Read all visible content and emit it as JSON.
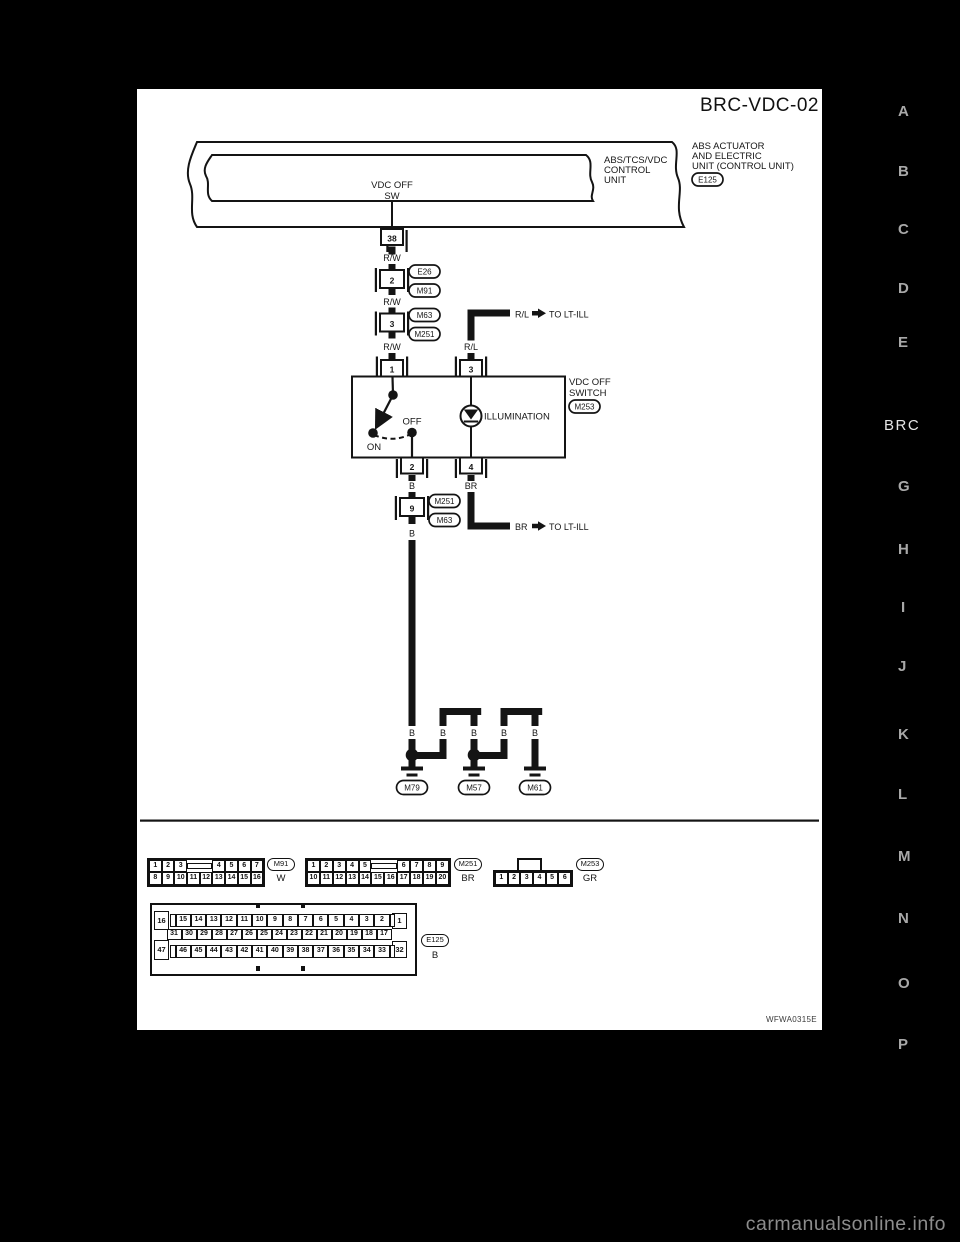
{
  "page": {
    "title": "BRC-VDC-02",
    "figure_code": "WFWA0315E",
    "watermark": "carmanualsonline.info"
  },
  "side_index": {
    "section": "BRC",
    "letters": [
      "A",
      "B",
      "C",
      "D",
      "E",
      "G",
      "H",
      "I",
      "J",
      "K",
      "L",
      "M",
      "N",
      "O",
      "P"
    ]
  },
  "unit": {
    "outer_name": [
      "ABS ACTUATOR",
      "AND ELECTRIC",
      "UNIT (CONTROL UNIT)"
    ],
    "outer_connector": "E125",
    "inner_name": [
      "ABS/TCS/VDC",
      "CONTROL",
      "UNIT"
    ],
    "signal": [
      "VDC OFF",
      "SW"
    ],
    "pin": "38"
  },
  "wire_colors": {
    "rw": "R/W",
    "rl": "R/L",
    "b": "B",
    "br": "BR"
  },
  "branches": {
    "to_lt_ill": "TO LT-ILL"
  },
  "inline_connectors": {
    "c2": {
      "pin": "2",
      "upper": "E26",
      "lower": "M91"
    },
    "c3": {
      "pin": "3",
      "upper": "M63",
      "lower": "M251"
    },
    "c9": {
      "pin": "9",
      "upper": "M251",
      "lower": "M63"
    }
  },
  "switch": {
    "name": [
      "VDC OFF",
      "SWITCH"
    ],
    "connector": "M253",
    "pin_top_left": "1",
    "pin_top_right": "3",
    "pin_bottom_left": "2",
    "pin_bottom_right": "4",
    "on": "ON",
    "off": "OFF",
    "illumination": "ILLUMINATION"
  },
  "grounds": {
    "g1": "M79",
    "g2": "M57",
    "g3": "M61"
  },
  "pinouts": {
    "m91": {
      "label": "M91",
      "color": "W",
      "row1_left": [
        "1",
        "2",
        "3"
      ],
      "row1_right": [
        "4",
        "5",
        "6",
        "7"
      ],
      "row2": [
        "8",
        "9",
        "10",
        "11",
        "12",
        "13",
        "14",
        "15",
        "16"
      ]
    },
    "m251": {
      "label": "M251",
      "color": "BR",
      "row1_left": [
        "1",
        "2",
        "3",
        "4",
        "5"
      ],
      "row1_right": [
        "6",
        "7",
        "8",
        "9"
      ],
      "row2": [
        "10",
        "11",
        "12",
        "13",
        "14",
        "15",
        "16",
        "17",
        "18",
        "19",
        "20"
      ]
    },
    "m253": {
      "label": "M253",
      "color": "GR",
      "row": [
        "1",
        "2",
        "3",
        "4",
        "5",
        "6"
      ]
    },
    "e125": {
      "label": "E125",
      "color": "B",
      "corner_top_left": "16",
      "corner_bottom_left": "47",
      "corner_top_right": "1",
      "corner_bottom_right": "32",
      "row1": [
        "15",
        "14",
        "13",
        "12",
        "11",
        "10",
        "9",
        "8",
        "7",
        "6",
        "5",
        "4",
        "3",
        "2"
      ],
      "row2": [
        "31",
        "30",
        "29",
        "28",
        "27",
        "26",
        "25",
        "24",
        "23",
        "22",
        "21",
        "20",
        "19",
        "18",
        "17"
      ],
      "row3": [
        "46",
        "45",
        "44",
        "43",
        "42",
        "41",
        "40",
        "39",
        "38",
        "37",
        "36",
        "35",
        "34",
        "33"
      ]
    }
  }
}
